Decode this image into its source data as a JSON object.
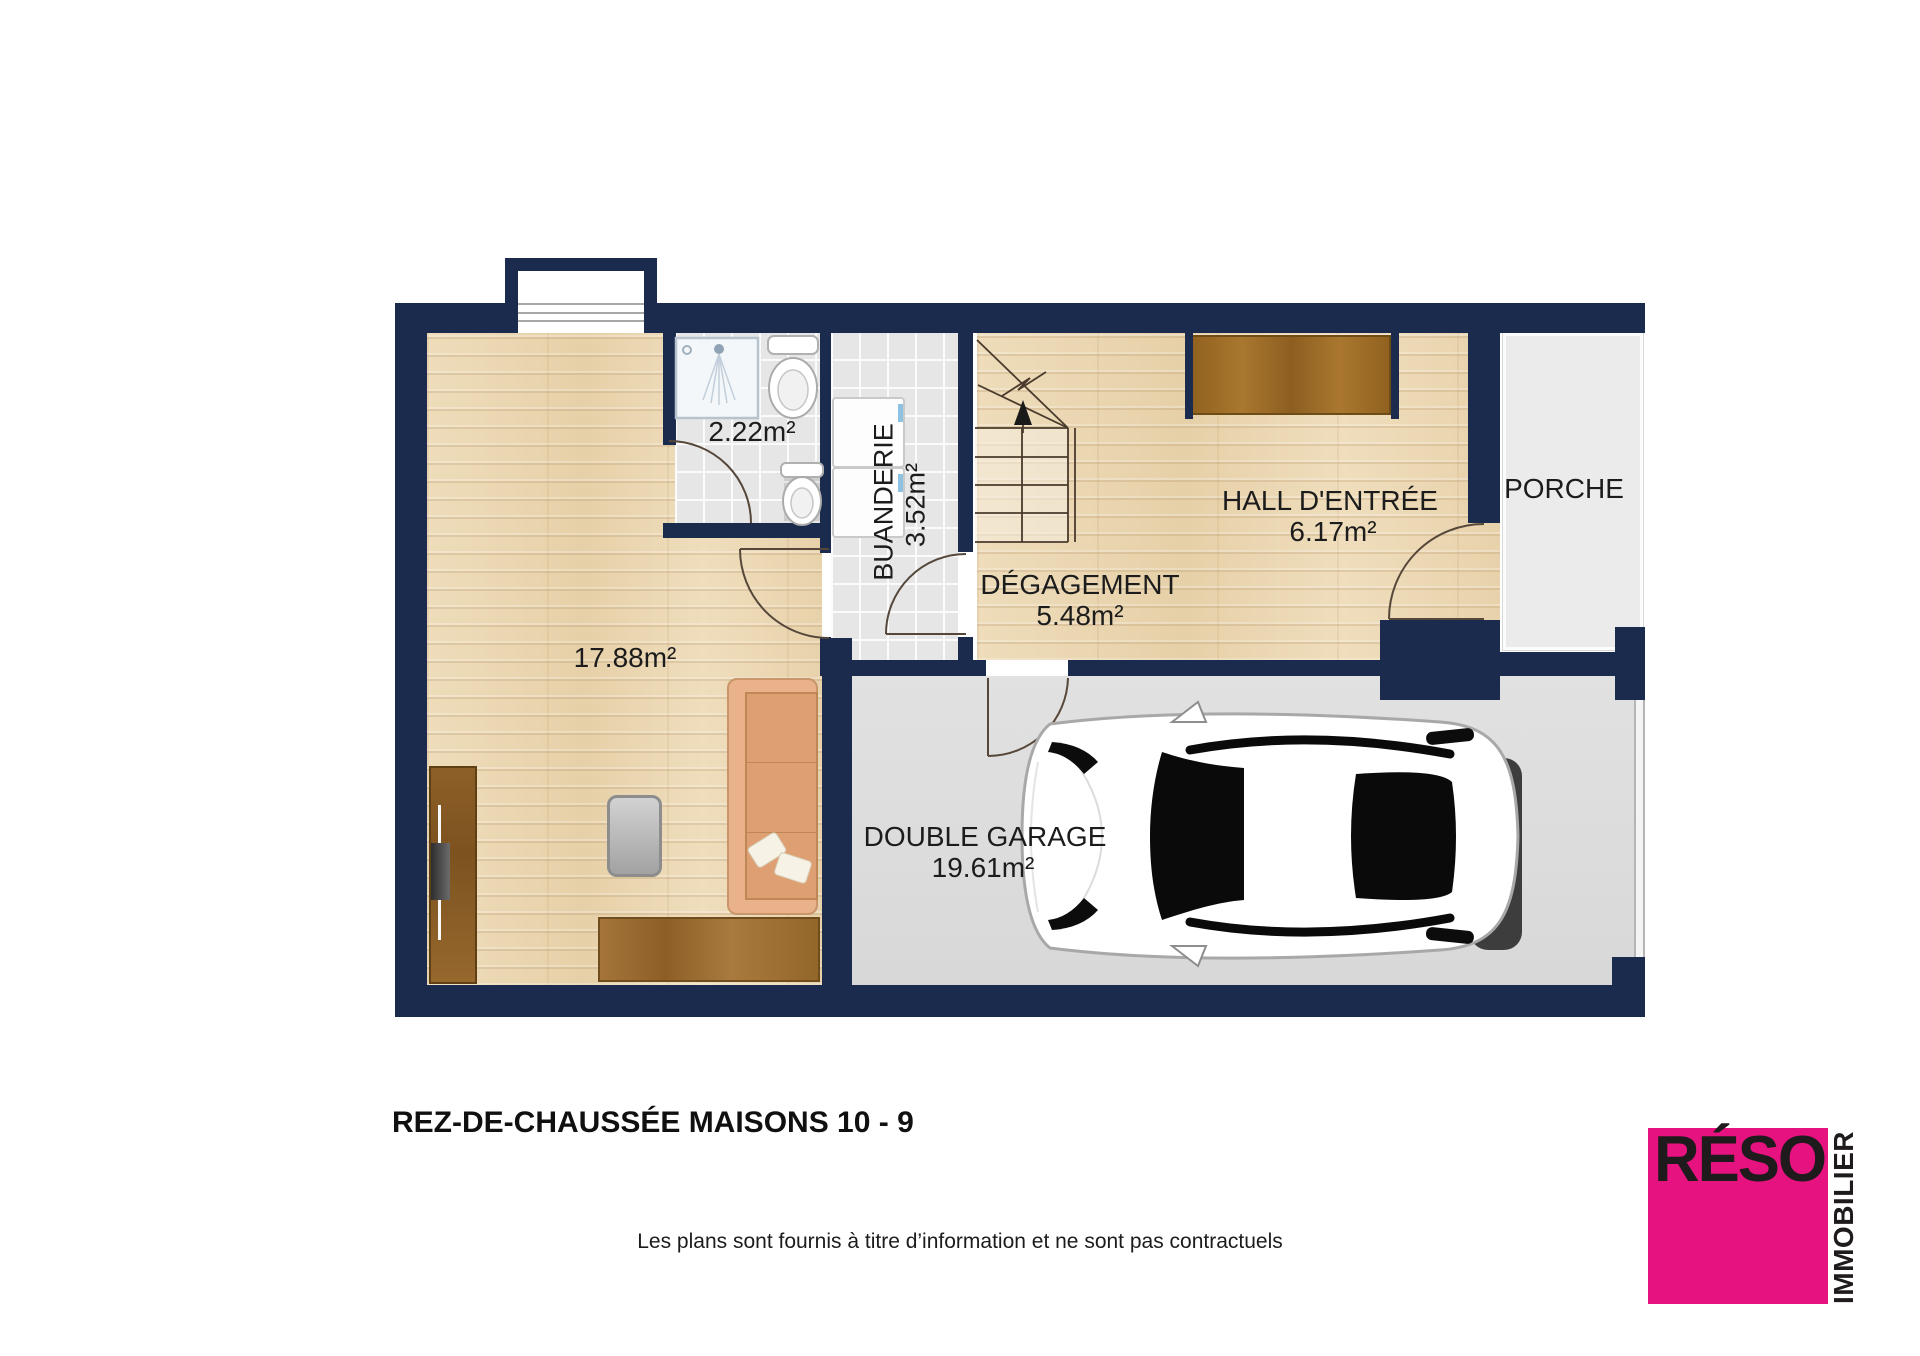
{
  "document": {
    "title": "REZ-DE-CHAUSSÉE MAISONS 10 - 9",
    "disclaimer": "Les plans sont fournis à titre d’information et ne sont pas contractuels"
  },
  "logo": {
    "brand": "RÉSO",
    "subtitle": "IMMOBILIER",
    "square_color": "#e5127f",
    "text_color": "#1f1a1b"
  },
  "rooms": {
    "living": {
      "area": "17.88m²"
    },
    "bathroom": {
      "area": "2.22m²"
    },
    "laundry": {
      "name": "BUANDERIE",
      "area": "3.52m²"
    },
    "hallway": {
      "name": "DÉGAGEMENT",
      "area": "5.48m²"
    },
    "entry_hall": {
      "name": "HALL D'ENTRÉE",
      "area": "6.17m²"
    },
    "porch": {
      "name": "PORCHE"
    },
    "garage": {
      "name": "DOUBLE GARAGE",
      "area": "19.61m²"
    }
  },
  "colors": {
    "wall": "#1b2b4d",
    "wood_floor": "#ebd8b4",
    "tile_floor": "#e6e6e6",
    "garage_floor": "#dddddd",
    "porch_floor": "#ebebeb",
    "label_text": "#1c1c1c"
  },
  "icons": [
    "stairs-icon",
    "shower-icon",
    "toilet-icon",
    "wc-toilet-icon",
    "washer-icon",
    "dryer-icon",
    "car-icon",
    "sofa-icon",
    "tv-icon",
    "wardrobe-icon",
    "sideboard-icon",
    "window-icon",
    "door-arc-icon"
  ]
}
